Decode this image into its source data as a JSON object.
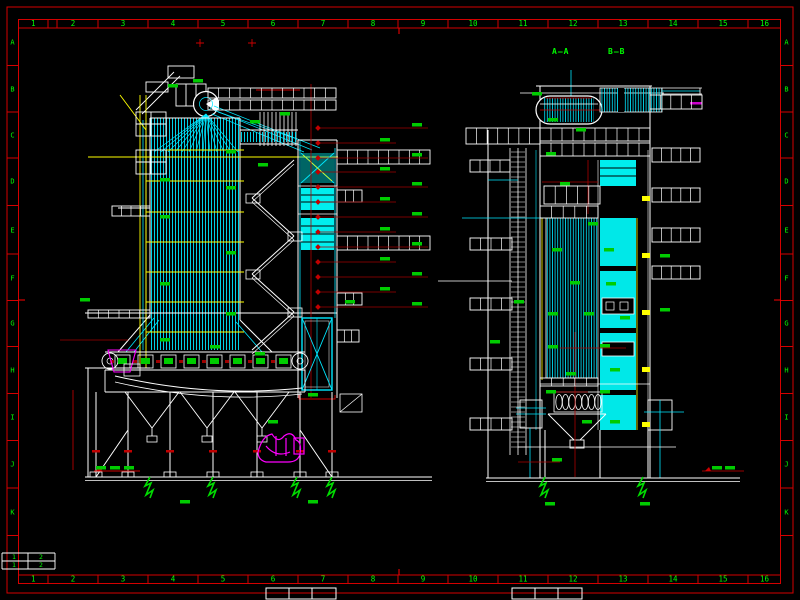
{
  "sheet": {
    "background": "#000000",
    "frame_color": "#d40000",
    "tick_color": "#ff0000",
    "label_color": "#00ff00",
    "top_numbers": [
      "1",
      "2",
      "3",
      "4",
      "5",
      "6",
      "7",
      "8",
      "9",
      "10",
      "11",
      "12",
      "13",
      "14",
      "15",
      "16"
    ],
    "bottom_numbers": [
      "1",
      "2",
      "3",
      "4",
      "5",
      "6",
      "7",
      "8",
      "9",
      "10",
      "11",
      "12",
      "13",
      "14",
      "15",
      "16"
    ],
    "left_letters": [
      "A",
      "B",
      "C",
      "D",
      "E",
      "F",
      "G",
      "H",
      "I",
      "J",
      "K"
    ],
    "right_letters": [
      "A",
      "B",
      "C",
      "D",
      "E",
      "F",
      "G",
      "H",
      "I",
      "J",
      "K"
    ],
    "corner_digits": [
      "1",
      "2",
      "1",
      "2"
    ]
  },
  "views": {
    "section_a_label": "A—A",
    "section_b_label": "B—B"
  },
  "palette": {
    "tube_cyan": "#00e8ff",
    "fill_cyan": "#00eeee",
    "annotation_green": "#00cc00",
    "leader_red": "#a00000",
    "dim_red": "#cc0000",
    "pipe_yellow": "#ffff00",
    "equipment_magenta": "#ff00ff",
    "line_white": "#ffffff"
  }
}
